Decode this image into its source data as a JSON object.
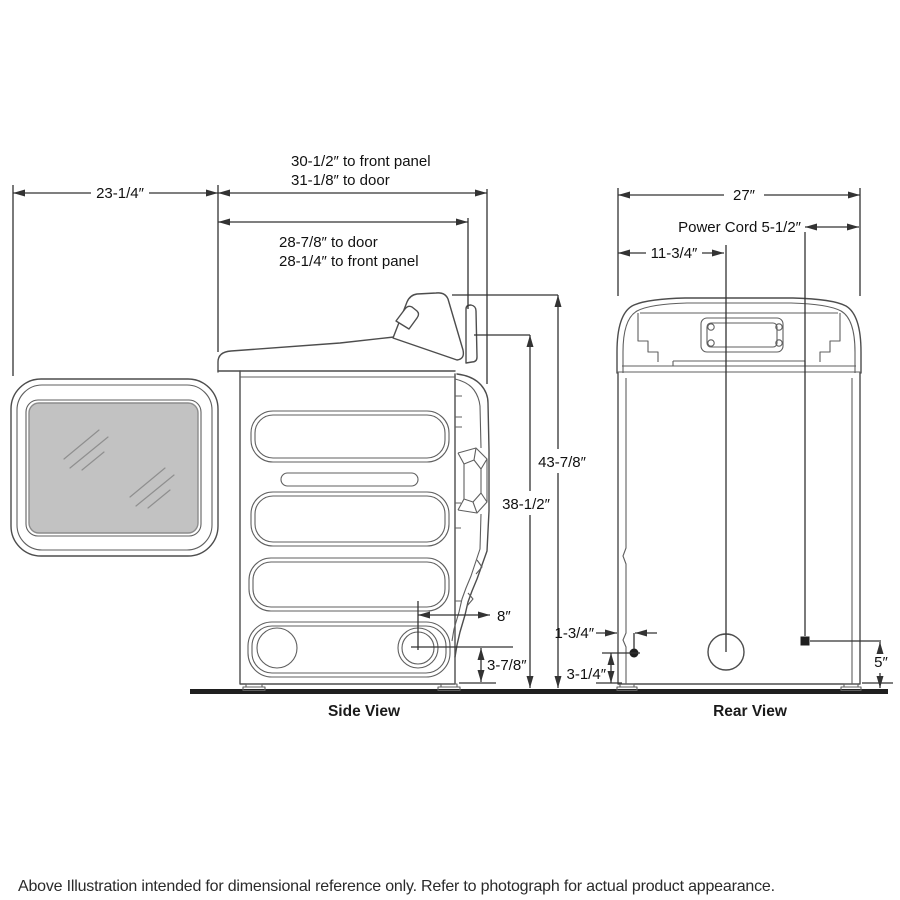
{
  "figure": {
    "side_view": {
      "caption": "Side View",
      "dims": {
        "top_primary_line1": "30-1/2″ to front panel",
        "top_primary_line2": "31-1/8″ to door",
        "top_secondary_line1": "28-7/8″ to door",
        "top_secondary_line2": "28-1/4″ to front panel",
        "door_open_depth": "23-1/4″",
        "overall_height": "43-7/8″",
        "front_panel_height": "38-1/2″",
        "vent_setback": "8″",
        "vent_center_height": "3-7/8″"
      }
    },
    "rear_view": {
      "caption": "Rear View",
      "dims": {
        "width": "27″",
        "power_cord": "Power Cord 5-1/2″",
        "exhaust_offset": "11-3/4″",
        "gas_line_offset": "1-3/4″",
        "gas_line_height": "3-1/4″",
        "power_cord_height": "5″"
      }
    }
  },
  "footer": {
    "disclaimer": "Above Illustration intended for dimensional reference only. Refer to photograph for actual product appearance."
  }
}
